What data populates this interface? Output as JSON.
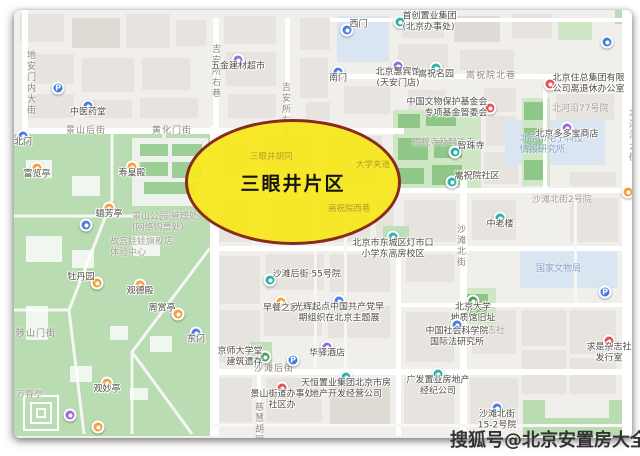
{
  "page": {
    "watermark": "搜狐号@北京安置房大全"
  },
  "highlight": {
    "label": "三眼井片区",
    "fill": "rgba(247,232,32,0.96)",
    "border": "#8A2A1C"
  },
  "map": {
    "streets": [
      {
        "text": "地安门内大街",
        "x": 10,
        "y": 40,
        "v": true
      },
      {
        "text": "景山后街",
        "x": 52,
        "y": 113
      },
      {
        "text": "黄化门街",
        "x": 138,
        "y": 113
      },
      {
        "text": "吉安所右巷",
        "x": 195,
        "y": 34,
        "v": true
      },
      {
        "text": "吉安所左巷",
        "x": 265,
        "y": 72,
        "v": true
      },
      {
        "text": "嵩祝院北巷",
        "x": 452,
        "y": 58
      },
      {
        "text": "北河沿大街",
        "x": 612,
        "y": 98,
        "v": true
      },
      {
        "text": "沙滩北街",
        "x": 440,
        "y": 214,
        "v": true
      },
      {
        "text": "沙滩后街",
        "x": 240,
        "y": 351
      },
      {
        "text": "陟山门街",
        "x": 2,
        "y": 316
      },
      {
        "text": "慈慧胡同",
        "x": 238,
        "y": 392,
        "v": true
      }
    ],
    "areas": [
      {
        "text": "嵩祝寺及智珠寺",
        "x": 398,
        "y": 128,
        "cls": ""
      },
      {
        "text": "北河沿77号院",
        "x": 538,
        "y": 94,
        "cls": ""
      },
      {
        "text": "沙滩北街2号院",
        "x": 518,
        "y": 185,
        "cls": ""
      },
      {
        "text": "求是杂志社",
        "x": 446,
        "y": 316,
        "cls": ""
      },
      {
        "text": "国家文物局",
        "x": 522,
        "y": 254,
        "cls": "blue"
      },
      {
        "text": "北京市电子科技\n情报研究所",
        "x": 506,
        "y": 124,
        "cls": "blue"
      },
      {
        "text": "景山公园·管理处\n(网络购票处)",
        "x": 118,
        "y": 202,
        "cls": ""
      },
      {
        "text": "故宫娃娃旗舰店\n体验中心",
        "x": 96,
        "y": 227,
        "cls": ""
      },
      {
        "text": "万春亭",
        "x": 2,
        "y": 380,
        "cls": ""
      }
    ],
    "pois": [
      {
        "x": 224,
        "y": 50,
        "cat": "purple",
        "label": "五金建材超市",
        "pos": "below"
      },
      {
        "x": 44,
        "y": 78,
        "cat": "park",
        "glyph": "P",
        "label": "",
        "pos": "below"
      },
      {
        "x": 74,
        "y": 96,
        "cat": "blue",
        "label": "中医药堂",
        "pos": "below"
      },
      {
        "x": 333,
        "y": 20,
        "cat": "blue",
        "label": "西门",
        "pos": "right"
      },
      {
        "x": 386,
        "y": 12,
        "cat": "teal",
        "label": "首创置业集团\n(北京办事处)",
        "pos": "right"
      },
      {
        "x": 324,
        "y": 62,
        "cat": "blue",
        "label": "南门",
        "pos": "below"
      },
      {
        "x": 384,
        "y": 56,
        "cat": "purple",
        "label": "北京惠宾馆\n(天安门店)",
        "pos": "below"
      },
      {
        "x": 422,
        "y": 58,
        "cat": "teal",
        "label": "嵩祝名园",
        "pos": "below"
      },
      {
        "x": 593,
        "y": 32,
        "cat": "blue",
        "label": "",
        "pos": "below"
      },
      {
        "x": 536,
        "y": 74,
        "cat": "red",
        "label": "北京住总集团有限\n公司离退休办公室",
        "pos": "right"
      },
      {
        "x": 476,
        "y": 98,
        "cat": "red",
        "label": "中国文物保护基金会\n专项基金管委会",
        "pos": "left"
      },
      {
        "x": 553,
        "y": 118,
        "cat": "purple",
        "label": "北京多多宝商店",
        "pos": "below"
      },
      {
        "x": 441,
        "y": 142,
        "cat": "teal",
        "label": "智珠寺",
        "pos": "right"
      },
      {
        "x": 438,
        "y": 172,
        "cat": "teal",
        "label": "嵩祝院社区",
        "pos": "right"
      },
      {
        "x": 614,
        "y": 182,
        "cat": "orange",
        "label": "",
        "pos": "below"
      },
      {
        "x": 486,
        "y": 208,
        "cat": "teal",
        "label": "中老楼",
        "pos": "below"
      },
      {
        "x": 379,
        "y": 227,
        "cat": "teal",
        "label": "北京市东城区灯市口\n小学东高房校区",
        "pos": "below"
      },
      {
        "x": 182,
        "y": 323,
        "cat": "blue",
        "label": "东门",
        "pos": "below"
      },
      {
        "x": 256,
        "y": 270,
        "cat": "teal",
        "label": "沙滩后街·55号院",
        "pos": "right"
      },
      {
        "x": 267,
        "y": 292,
        "cat": "orange",
        "label": "早餐之家",
        "pos": "below"
      },
      {
        "x": 325,
        "y": 291,
        "cat": "blue",
        "label": "光辉起点中国共产党早\n期组织在北京主题展",
        "pos": "below"
      },
      {
        "x": 251,
        "y": 347,
        "cat": "green",
        "label": "京师大学堂\n建筑遗存",
        "pos": "left"
      },
      {
        "x": 279,
        "y": 350,
        "cat": "park",
        "glyph": "P",
        "label": "",
        "pos": "below"
      },
      {
        "x": 313,
        "y": 337,
        "cat": "purple",
        "label": "华驿酒店",
        "pos": "below"
      },
      {
        "x": 268,
        "y": 378,
        "cat": "red",
        "label": "景山街道办事处\n社区办",
        "pos": "below"
      },
      {
        "x": 332,
        "y": 367,
        "cat": "teal",
        "label": "天恒置业集团北京市房\n地产开发经营公司",
        "pos": "below"
      },
      {
        "x": 424,
        "y": 364,
        "cat": "teal",
        "label": "广发置业房地产\n经纪公司",
        "pos": "below"
      },
      {
        "x": 459,
        "y": 291,
        "cat": "green",
        "label": "北京大学\n地质馆旧址",
        "pos": "below"
      },
      {
        "x": 443,
        "y": 315,
        "cat": "blue",
        "label": "中国社会科学院\n国际法研究所",
        "pos": "below"
      },
      {
        "x": 591,
        "y": 282,
        "cat": "park",
        "glyph": "P",
        "label": "",
        "pos": "below"
      },
      {
        "x": 595,
        "y": 331,
        "cat": "red",
        "label": "求是杂志社\n发行室",
        "pos": "below"
      },
      {
        "x": 483,
        "y": 398,
        "cat": "blue",
        "label": "沙滩北街\n15-2号院",
        "pos": "below"
      },
      {
        "x": 9,
        "y": 126,
        "cat": "blue",
        "label": "北门",
        "pos": "below"
      },
      {
        "x": 23,
        "y": 158,
        "cat": "orange",
        "label": "富览亭",
        "pos": "below"
      },
      {
        "x": 118,
        "y": 157,
        "cat": "orange",
        "label": "寿皇殿",
        "pos": "below"
      },
      {
        "x": 95,
        "y": 198,
        "cat": "orange",
        "label": "辑芳亭",
        "pos": "below"
      },
      {
        "x": 83,
        "y": 273,
        "cat": "orange",
        "label": "牡丹园",
        "pos": "left"
      },
      {
        "x": 126,
        "y": 275,
        "cat": "orange",
        "label": "观德殿",
        "pos": "below"
      },
      {
        "x": 164,
        "y": 304,
        "cat": "orange",
        "label": "周赏亭",
        "pos": "left"
      },
      {
        "x": 93,
        "y": 373,
        "cat": "orange",
        "label": "观妙亭",
        "pos": "below"
      },
      {
        "x": 56,
        "y": 405,
        "cat": "purple",
        "label": "",
        "pos": "below"
      },
      {
        "x": 84,
        "y": 417,
        "cat": "orange",
        "label": "",
        "pos": "below"
      },
      {
        "x": 72,
        "y": 215,
        "cat": "blue",
        "label": "",
        "pos": "below"
      }
    ],
    "faint": [
      {
        "text": "三眼井胡同",
        "x": 236,
        "y": 140
      },
      {
        "text": "大学夹道",
        "x": 342,
        "y": 148
      },
      {
        "text": "嵩祝院西巷",
        "x": 314,
        "y": 192
      }
    ]
  }
}
